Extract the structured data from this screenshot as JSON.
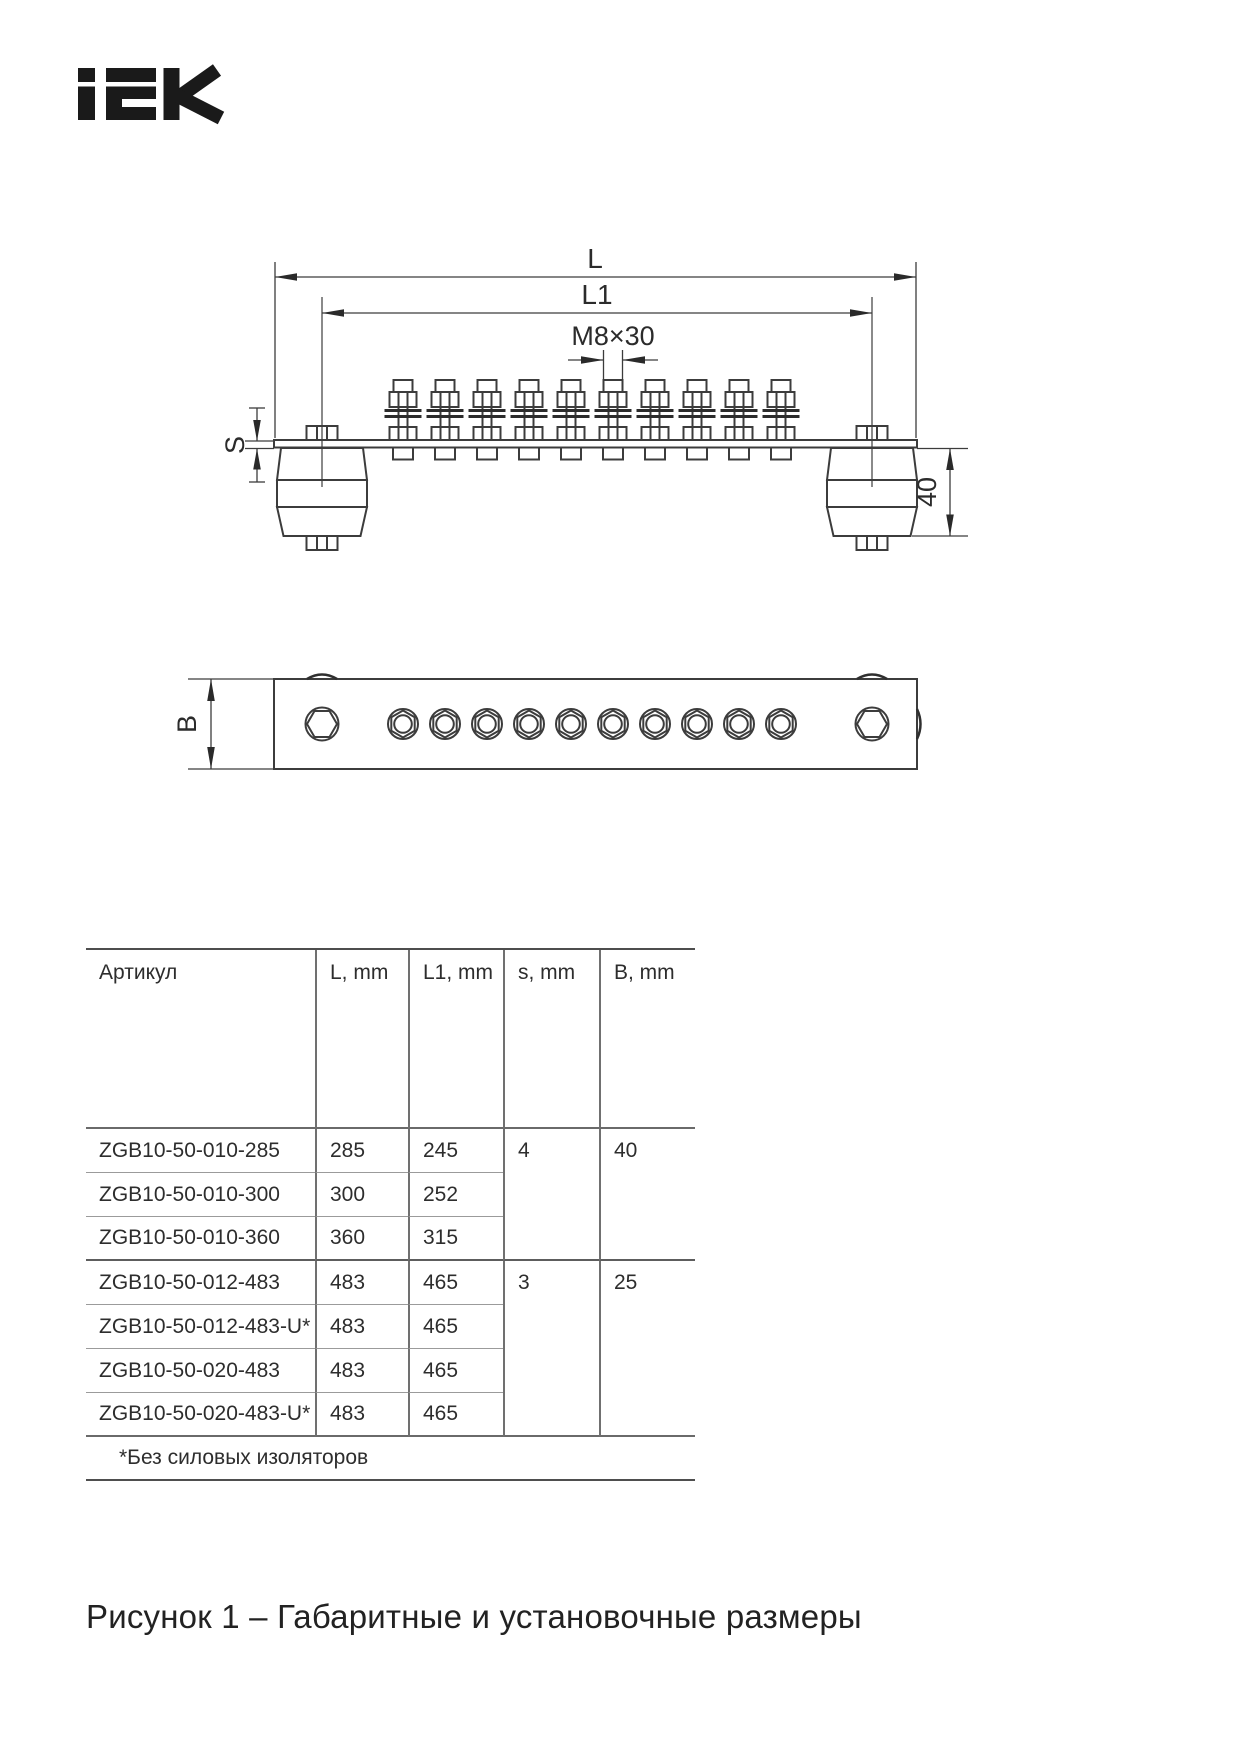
{
  "logo": {
    "text": "IEK",
    "color": "#1a1a1a"
  },
  "drawing": {
    "line_color": "#3c3c3c",
    "labels": {
      "l": "L",
      "l1": "L1",
      "thread": "M8×30",
      "s": "S",
      "height": "40",
      "b": "B"
    },
    "bolt_count": 10,
    "insulator_count": 2
  },
  "table": {
    "headers": [
      "Артикул",
      "L, mm",
      "L1, mm",
      "s, mm",
      "B, mm"
    ],
    "rows": [
      {
        "article": "ZGB10-50-010-285",
        "l": "285",
        "l1": "245",
        "s": "4",
        "b": "40"
      },
      {
        "article": "ZGB10-50-010-300",
        "l": "300",
        "l1": "252"
      },
      {
        "article": "ZGB10-50-010-360",
        "l": "360",
        "l1": "315"
      },
      {
        "article": "ZGB10-50-012-483",
        "l": "483",
        "l1": "465",
        "s": "3",
        "b": "25"
      },
      {
        "article": "ZGB10-50-012-483-U*",
        "l": "483",
        "l1": "465"
      },
      {
        "article": "ZGB10-50-020-483",
        "l": "483",
        "l1": "465"
      },
      {
        "article": "ZGB10-50-020-483-U*",
        "l": "483",
        "l1": "465"
      }
    ],
    "footnote": "*Без силовых изоляторов"
  },
  "caption": "Рисунок 1 – Габаритные и установочные размеры"
}
